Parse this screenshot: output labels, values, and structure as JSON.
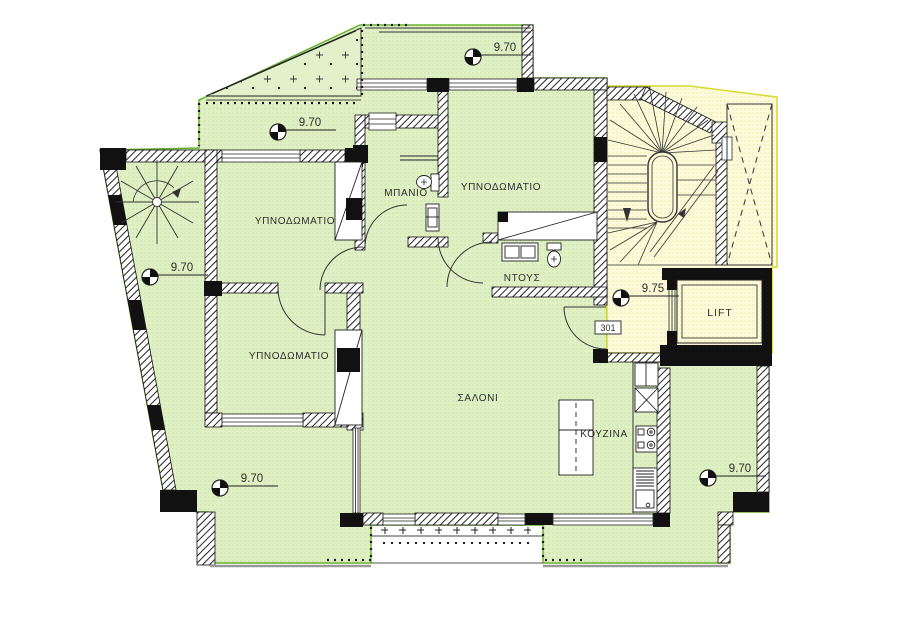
{
  "plan": {
    "name": "apartment-floor-plan",
    "unit_number": "301",
    "rooms": {
      "bedroom_top": {
        "label": "ΥΠΝΟΔΩΜΑΤΙΟ"
      },
      "bedroom_upper_left": {
        "label": "ΥΠΝΟΔΩΜΑΤΙΟ"
      },
      "bedroom_lower_left": {
        "label": "ΥΠΝΟΔΩΜΑΤΙΟ"
      },
      "bathroom": {
        "label": "ΜΠΑΝΙΟ"
      },
      "shower": {
        "label": "ΝΤΟΥΣ"
      },
      "living_room": {
        "label": "ΣΑΛΟΝΙ"
      },
      "kitchen": {
        "label": "ΚΟΥΖΙΝΑ"
      },
      "lift": {
        "label": "LIFT"
      }
    },
    "levels": [
      {
        "value": "9.70",
        "x": 473,
        "y": 57
      },
      {
        "value": "9.70",
        "x": 278,
        "y": 132
      },
      {
        "value": "9.70",
        "x": 150,
        "y": 277
      },
      {
        "value": "9.70",
        "x": 220,
        "y": 488
      },
      {
        "value": "9.70",
        "x": 708,
        "y": 478
      },
      {
        "value": "9.75",
        "x": 621,
        "y": 298
      }
    ],
    "colors": {
      "apartment_fill": "#def0c4",
      "apartment_outline": "#69b22d",
      "stairwell_fill": "#fcfad8",
      "stairwell_outline": "#d9d92e",
      "wall_line": "#1b1b1b"
    }
  }
}
